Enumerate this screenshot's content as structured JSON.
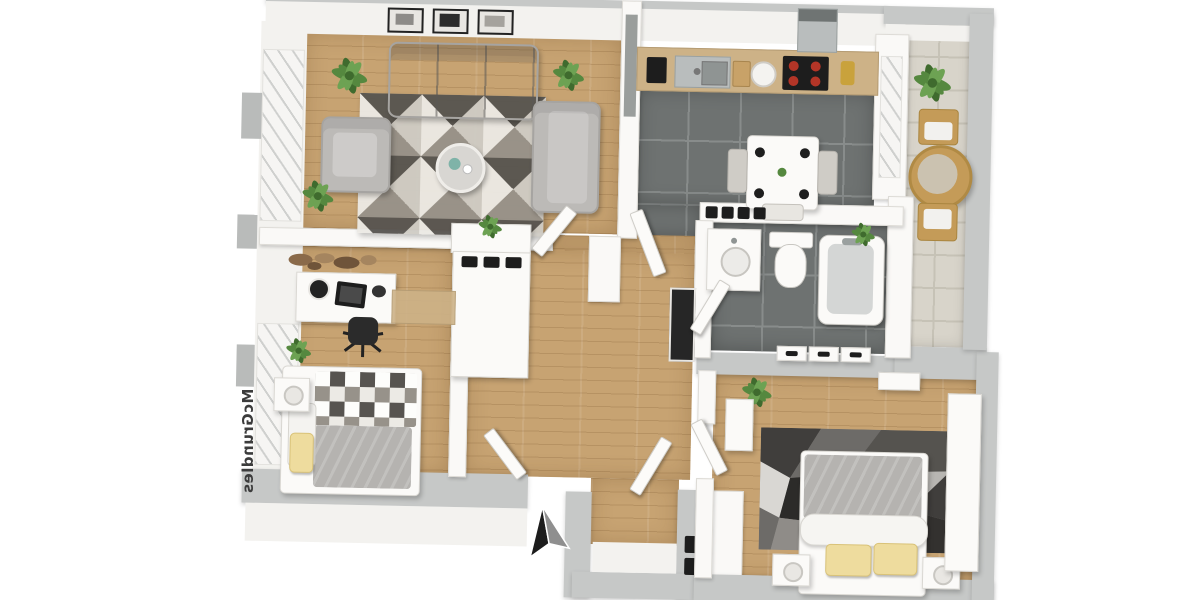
{
  "scene": {
    "type": "3d-floor-plan-render",
    "view": "top-down",
    "watermark": {
      "text": "McGrundles"
    },
    "north_arrow": {
      "icon": "north-arrow"
    }
  },
  "rooms": [
    {
      "id": "living-room",
      "floor": "wood",
      "furniture": [
        "sofa",
        "armchair",
        "loveseat",
        "coffee-table",
        "geometric-rug",
        "plants",
        "wall-pictures"
      ]
    },
    {
      "id": "kitchen",
      "floor": "dark-tile",
      "furniture": [
        "counter",
        "sink",
        "cooktop",
        "coffee-machine",
        "hood",
        "dining-table",
        "chairs"
      ]
    },
    {
      "id": "balcony",
      "floor": "light-tile",
      "furniture": [
        "round-table",
        "two-chairs",
        "plant"
      ]
    },
    {
      "id": "bathroom",
      "floor": "dark-tile",
      "furniture": [
        "vanity-sink",
        "toilet",
        "bathtub",
        "radiator"
      ]
    },
    {
      "id": "hallway",
      "floor": "wood",
      "furniture": [
        "wardrobe-unit",
        "sideboard-plant",
        "mirror",
        "open-doors"
      ]
    },
    {
      "id": "office-bedroom",
      "floor": "wood",
      "furniture": [
        "desk",
        "office-chair",
        "laptop",
        "single-bed",
        "nightstand",
        "wall-art",
        "plant"
      ]
    },
    {
      "id": "bedroom",
      "floor": "wood",
      "furniture": [
        "double-bed",
        "two-nightstands",
        "lamps",
        "low-poly-rug",
        "wardrobe",
        "plant"
      ]
    },
    {
      "id": "entry",
      "floor": "wood",
      "furniture": [
        "front-door-panel"
      ]
    }
  ],
  "colors": {
    "wood": "#c7a372",
    "tile_dark": "#6e7271",
    "grout_dark": "#888c8b",
    "tile_light": "#d8d4ca",
    "grout_light": "#c6c2b6",
    "wall_gray": "#c6c8c7",
    "wall_white": "#faf9f7",
    "wall_face": "#f3f2ef",
    "counter": "#cdb287",
    "sofa": "#bcbab7",
    "sofa_dark": "#a6a4a1",
    "rug_a": "#eceae5",
    "rug_b": "#cfccc5",
    "rug_c": "#97928a",
    "rug_d": "#575450",
    "pillow_yellow": "#eedc9e",
    "plant": "#55883f",
    "plant_dark": "#3f6b2e",
    "chair_wood": "#c49b58",
    "appliance": "#1d1d1d",
    "burner": "#b33527",
    "steel": "#b9bdbd",
    "arrow_dark": "#1c1c1c",
    "arrow_gray": "#8f8f8f",
    "watermark": "#3c3c3c",
    "bed_gray": "#b5b3b0",
    "mirror": "#262626",
    "gold": "#c9a23c",
    "teal": "#7fb3a8"
  }
}
